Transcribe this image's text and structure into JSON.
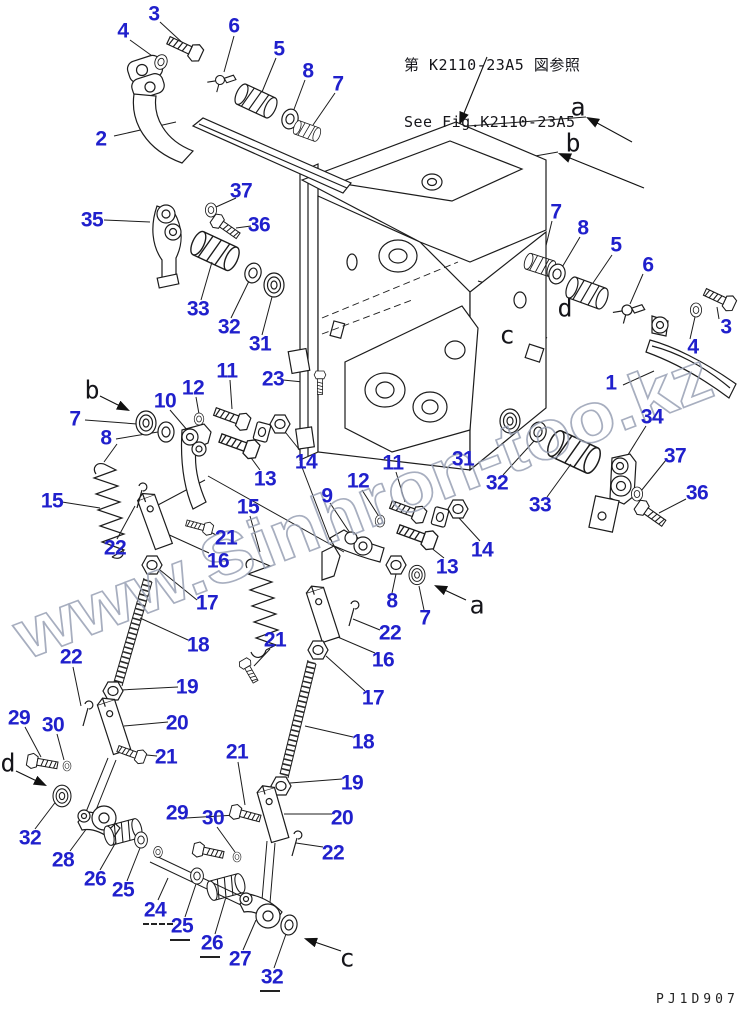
{
  "window": {
    "width": 747,
    "height": 1014,
    "background": "#ffffff"
  },
  "reference_note": {
    "jp": "第 K2110-23A5 図参照",
    "en": "See Fig.K2110-23A5"
  },
  "page_code": "PJ1D907",
  "watermark": {
    "text": "www.Sinhron-too.kz",
    "color": "#98a0b4"
  },
  "colors": {
    "callout_blue": "#2020cc",
    "line": "#1c1c1c",
    "view_letter": "#15151a"
  },
  "view_labels": [
    {
      "label": "a",
      "x": 578,
      "y": 107
    },
    {
      "label": "b",
      "x": 573,
      "y": 143
    },
    {
      "label": "d",
      "x": 565,
      "y": 308
    },
    {
      "label": "c",
      "x": 507,
      "y": 335
    },
    {
      "label": "b",
      "x": 92,
      "y": 390
    },
    {
      "label": "a",
      "x": 477,
      "y": 605
    },
    {
      "label": "d",
      "x": 8,
      "y": 763
    },
    {
      "label": "c",
      "x": 347,
      "y": 958
    }
  ],
  "callouts": [
    {
      "label": "3",
      "x": 154,
      "y": 14
    },
    {
      "label": "4",
      "x": 123,
      "y": 31
    },
    {
      "label": "6",
      "x": 234,
      "y": 26
    },
    {
      "label": "5",
      "x": 279,
      "y": 49
    },
    {
      "label": "8",
      "x": 308,
      "y": 71
    },
    {
      "label": "7",
      "x": 338,
      "y": 84
    },
    {
      "label": "2",
      "x": 101,
      "y": 139
    },
    {
      "label": "35",
      "x": 92,
      "y": 220
    },
    {
      "label": "37",
      "x": 241,
      "y": 191
    },
    {
      "label": "36",
      "x": 259,
      "y": 225
    },
    {
      "label": "33",
      "x": 198,
      "y": 309
    },
    {
      "label": "32",
      "x": 229,
      "y": 327
    },
    {
      "label": "31",
      "x": 260,
      "y": 344
    },
    {
      "label": "7",
      "x": 556,
      "y": 212
    },
    {
      "label": "8",
      "x": 583,
      "y": 228
    },
    {
      "label": "5",
      "x": 616,
      "y": 245
    },
    {
      "label": "6",
      "x": 648,
      "y": 265
    },
    {
      "label": "3",
      "x": 726,
      "y": 327
    },
    {
      "label": "4",
      "x": 693,
      "y": 347
    },
    {
      "label": "23",
      "x": 273,
      "y": 379
    },
    {
      "label": "11",
      "x": 227,
      "y": 371
    },
    {
      "label": "12",
      "x": 193,
      "y": 388
    },
    {
      "label": "10",
      "x": 165,
      "y": 401
    },
    {
      "label": "7",
      "x": 75,
      "y": 419
    },
    {
      "label": "8",
      "x": 106,
      "y": 438
    },
    {
      "label": "14",
      "x": 306,
      "y": 462
    },
    {
      "label": "13",
      "x": 265,
      "y": 479
    },
    {
      "label": "15",
      "x": 52,
      "y": 501
    },
    {
      "label": "15",
      "x": 248,
      "y": 507
    },
    {
      "label": "9",
      "x": 327,
      "y": 496
    },
    {
      "label": "22",
      "x": 115,
      "y": 548
    },
    {
      "label": "21",
      "x": 226,
      "y": 538
    },
    {
      "label": "16",
      "x": 218,
      "y": 561
    },
    {
      "label": "11",
      "x": 393,
      "y": 463
    },
    {
      "label": "12",
      "x": 358,
      "y": 481
    },
    {
      "label": "31",
      "x": 463,
      "y": 459
    },
    {
      "label": "32",
      "x": 497,
      "y": 483
    },
    {
      "label": "33",
      "x": 540,
      "y": 505
    },
    {
      "label": "14",
      "x": 482,
      "y": 550
    },
    {
      "label": "13",
      "x": 447,
      "y": 567
    },
    {
      "label": "8",
      "x": 392,
      "y": 601
    },
    {
      "label": "7",
      "x": 425,
      "y": 618
    },
    {
      "label": "1",
      "x": 611,
      "y": 383
    },
    {
      "label": "34",
      "x": 652,
      "y": 417
    },
    {
      "label": "37",
      "x": 675,
      "y": 456
    },
    {
      "label": "36",
      "x": 697,
      "y": 493
    },
    {
      "label": "17",
      "x": 207,
      "y": 603
    },
    {
      "label": "18",
      "x": 198,
      "y": 645
    },
    {
      "label": "22",
      "x": 71,
      "y": 657
    },
    {
      "label": "19",
      "x": 187,
      "y": 687
    },
    {
      "label": "20",
      "x": 177,
      "y": 723
    },
    {
      "label": "29",
      "x": 19,
      "y": 718
    },
    {
      "label": "30",
      "x": 53,
      "y": 725
    },
    {
      "label": "21",
      "x": 166,
      "y": 757
    },
    {
      "label": "21",
      "x": 237,
      "y": 752
    },
    {
      "label": "21",
      "x": 275,
      "y": 640
    },
    {
      "label": "22",
      "x": 390,
      "y": 633
    },
    {
      "label": "16",
      "x": 383,
      "y": 660
    },
    {
      "label": "17",
      "x": 373,
      "y": 698
    },
    {
      "label": "18",
      "x": 363,
      "y": 742
    },
    {
      "label": "19",
      "x": 352,
      "y": 783
    },
    {
      "label": "20",
      "x": 342,
      "y": 818
    },
    {
      "label": "22",
      "x": 333,
      "y": 853
    },
    {
      "label": "32",
      "x": 30,
      "y": 838
    },
    {
      "label": "28",
      "x": 63,
      "y": 860
    },
    {
      "label": "26",
      "x": 95,
      "y": 879
    },
    {
      "label": "25",
      "x": 123,
      "y": 890
    },
    {
      "label": "24",
      "x": 155,
      "y": 910,
      "dash": 2
    },
    {
      "label": "25",
      "x": 182,
      "y": 926,
      "dash": 1
    },
    {
      "label": "26",
      "x": 212,
      "y": 943,
      "dash": 1
    },
    {
      "label": "27",
      "x": 240,
      "y": 959
    },
    {
      "label": "32",
      "x": 272,
      "y": 977,
      "dash": 1
    },
    {
      "label": "29",
      "x": 177,
      "y": 813
    },
    {
      "label": "30",
      "x": 213,
      "y": 818
    }
  ]
}
